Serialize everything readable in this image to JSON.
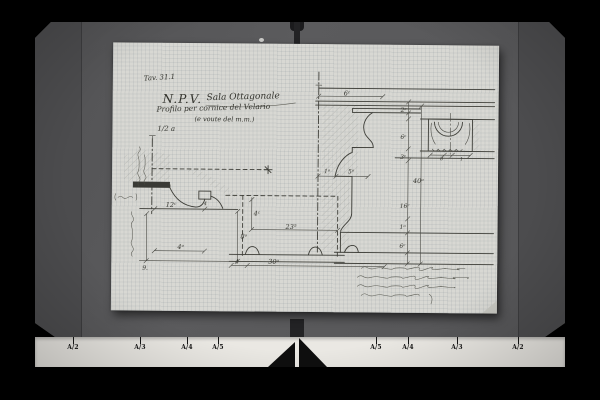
{
  "palette": {
    "background": "#000000",
    "board": "#59595b",
    "board_flap": "#4c4c4e",
    "paper": "#d8d8d3",
    "ink": "#3e3e38",
    "scale_strip": "#eae8e3",
    "marker_triangles": "#0e0e0e"
  },
  "drawing": {
    "plate_label": "Tav. 31.1",
    "title_main": "N.P.V.",
    "title_room": "Sala Ottagonale",
    "subtitle": "Profilo per cornice del Velario",
    "subtitle_paren": "(e voute del m.m.)",
    "scale_label": "1/2 a",
    "dims": {
      "left_width": "12ᶜ",
      "left_block": "4",
      "left_height": "8ᵒ",
      "left_span": "4ᵒ",
      "left_index": "9.",
      "base_offset": "4",
      "center_height": "4ᶜ",
      "center_width": "23⁵",
      "center_base": "30ᵒ",
      "cap_width": "6ᶜ",
      "off_small": "1ᵒ",
      "off_large": "5ᵒ",
      "chain_1": "2ᶜ",
      "chain_2": "6ᶜ",
      "chain_3": "3ᶜ",
      "chain_total": "40ᵒ",
      "chain_4": "16ᶜ",
      "chain_5": "1ᵒ",
      "chain_6": "6ᶜ",
      "ornament_a": "8",
      "ornament_b": "1"
    }
  },
  "scale_bar": {
    "left_labels": [
      "A/2",
      "A/3",
      "A/4",
      "A/5"
    ],
    "right_labels": [
      "A/5",
      "A/4",
      "A/3",
      "A/2"
    ]
  }
}
